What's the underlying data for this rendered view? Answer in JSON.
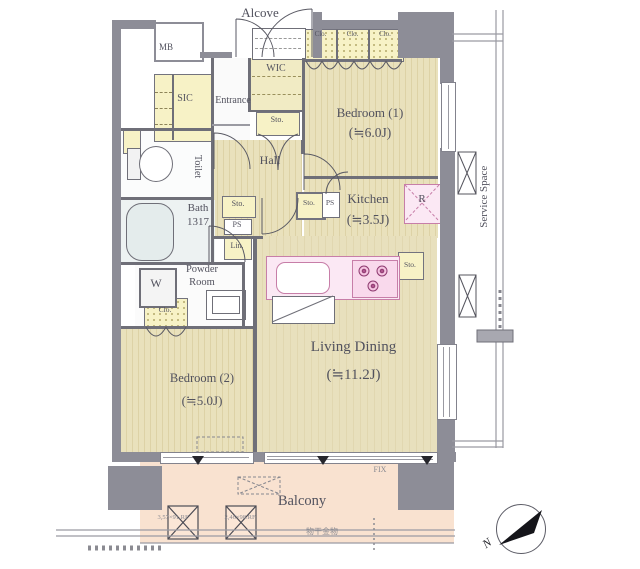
{
  "document_type": "apartment floor plan",
  "colors": {
    "wall": "#8d8d97",
    "room_floor": "#e9e1bc",
    "closet": "#f7f2c6",
    "kitchen_pink": "#fbe8f4",
    "balcony": "#f9e2d0",
    "bath": "#edf2f2",
    "label_text": "#52525e"
  },
  "rooms": {
    "alcove": {
      "label": "Alcove"
    },
    "mb": {
      "label": "MB"
    },
    "wic": {
      "label": "WIC"
    },
    "closets_top": {
      "c1": "Clo.",
      "c2": "Clo.",
      "c3": "Clo."
    },
    "sic": {
      "label": "SIC"
    },
    "entrance": {
      "label": "Entrance"
    },
    "sto_wic": {
      "label": "Sto."
    },
    "bedroom1": {
      "label": "Bedroom (1)",
      "size": "(≒6.0J)"
    },
    "toilet": {
      "label": "Toilet"
    },
    "hall": {
      "label": "Hall"
    },
    "bath": {
      "label": "Bath",
      "size": "1317"
    },
    "sto_hall": {
      "label": "Sto."
    },
    "ps_hall": {
      "label": "PS"
    },
    "lin": {
      "label": "Lin."
    },
    "kitchen": {
      "label": "Kitchen",
      "size": "(≒3.5J)"
    },
    "sto_kitchen": {
      "label": "Sto."
    },
    "ps_kitchen": {
      "label": "PS"
    },
    "refrigerator": {
      "label": "R"
    },
    "sto_counter": {
      "label": "Sto."
    },
    "washer": {
      "label": "W"
    },
    "powder": {
      "label_line1": "Powder",
      "label_line2": "Room"
    },
    "clo_bedroom2": {
      "label": "Clo."
    },
    "bedroom2": {
      "label": "Bedroom (2)",
      "size": "(≒5.0J)"
    },
    "living_dining": {
      "label": "Living Dining",
      "size": "(≒11.2J)"
    },
    "service_space": {
      "label": "Service Space"
    },
    "balcony": {
      "label": "Balcony",
      "fix_label": "FIX",
      "laundry_hardware": "物干金物",
      "ac_dim_1": "3,57×91.RF",
      "ac_dim_2": "2,46×98.RF"
    },
    "compass": {
      "north": "N"
    }
  }
}
